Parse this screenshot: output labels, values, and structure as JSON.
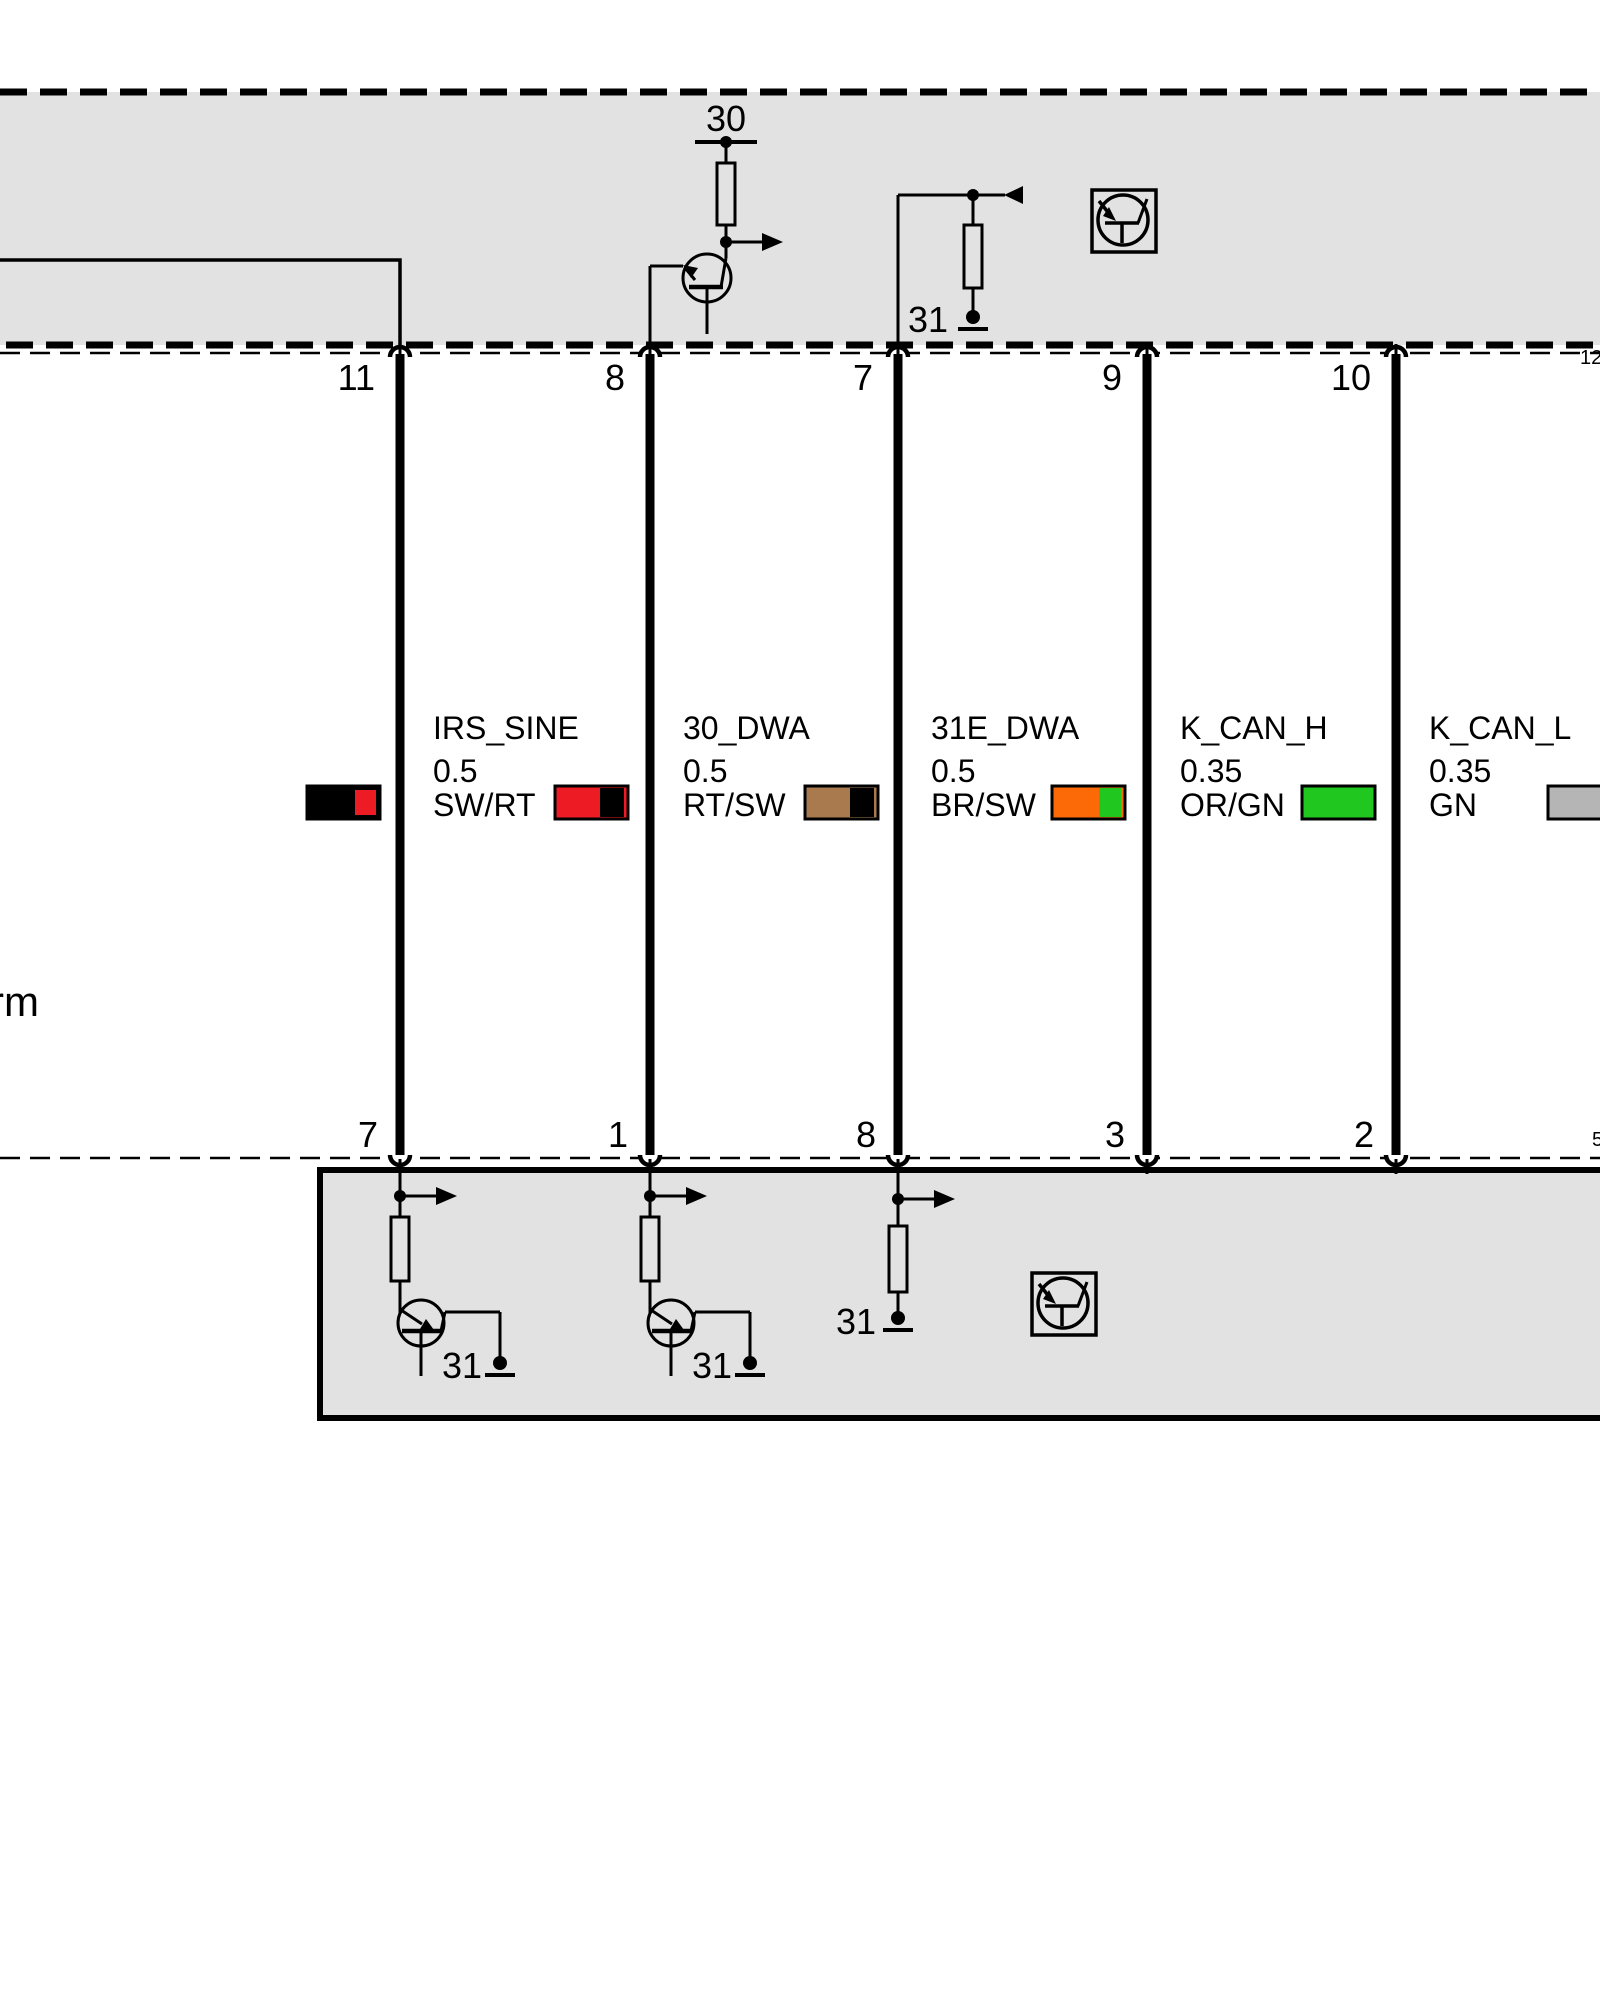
{
  "palette": {
    "module_fill": "#e2e2e2",
    "wire_black": "#000000",
    "red": "#ed1c24",
    "brown": "#a87a4e",
    "orange": "#fb6a07",
    "green": "#1fc71f",
    "gray_swatch": "#b5b5b5"
  },
  "top_module": {
    "terminal_30_label": "30",
    "ground_31_label": "31"
  },
  "connector_top_pins": {
    "c1": "11",
    "c2": "8",
    "c3": "7",
    "c4": "9",
    "c5": "10",
    "c6": "12"
  },
  "connector_bottom_pins": {
    "c1": "7",
    "c2": "1",
    "c3": "8",
    "c4": "3",
    "c5": "2",
    "c6": "5"
  },
  "wires": [
    {
      "name": "IRS_SINE",
      "gauge": "0.5",
      "color_code": "SW/RT",
      "swatch_main": "#000000",
      "swatch_stripe": "#ed1c24"
    },
    {
      "name": "30_DWA",
      "gauge": "0.5",
      "color_code": "RT/SW",
      "swatch_main": "#ed1c24",
      "swatch_stripe": "#000000"
    },
    {
      "name": "31E_DWA",
      "gauge": "0.5",
      "color_code": "BR/SW",
      "swatch_main": "#a87a4e",
      "swatch_stripe": "#000000"
    },
    {
      "name": "K_CAN_H",
      "gauge": "0.35",
      "color_code": "OR/GN",
      "swatch_main": "#fb6a07",
      "swatch_stripe": "#1fc71f"
    },
    {
      "name": "K_CAN_L",
      "gauge": "0.35",
      "color_code": "GN",
      "swatch_main": "#1fc71f"
    },
    {
      "swatch_main": "#b5b5b5"
    }
  ],
  "bottom_module": {
    "ground_labels": [
      "31",
      "31",
      "31"
    ]
  },
  "left_edge_label": "rm"
}
